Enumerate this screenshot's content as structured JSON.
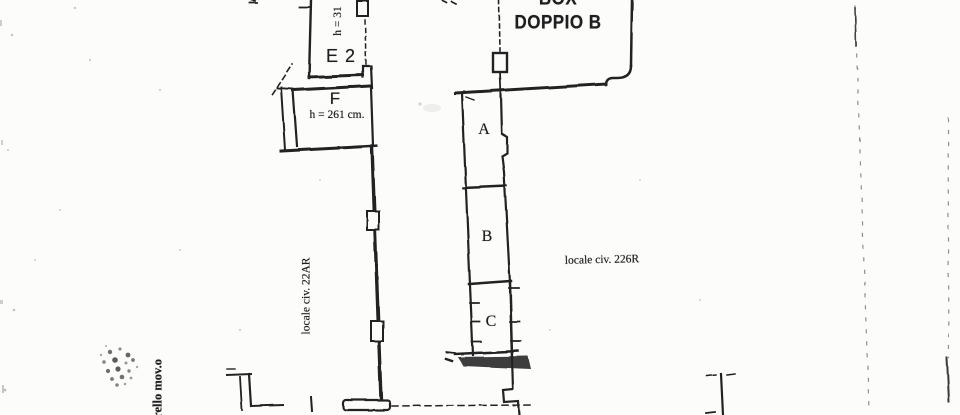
{
  "palette": {
    "ink": "#242424",
    "paper": "#fcfcfb"
  },
  "plan": {
    "box_label": {
      "line1": "BOX",
      "line2": "DOPPIO B"
    },
    "rooms": {
      "e2": {
        "label": "E 2",
        "height_note": "h = 31"
      },
      "f": {
        "label": "F",
        "height_note": "h = 261 cm."
      },
      "a": {
        "label": "A"
      },
      "b": {
        "label": "B"
      },
      "c": {
        "label": "C"
      }
    },
    "annotations": {
      "locale_left": "locale civ. 22AR",
      "locale_right": "locale civ. 226R",
      "bottom_left": "trello mov.o"
    }
  }
}
